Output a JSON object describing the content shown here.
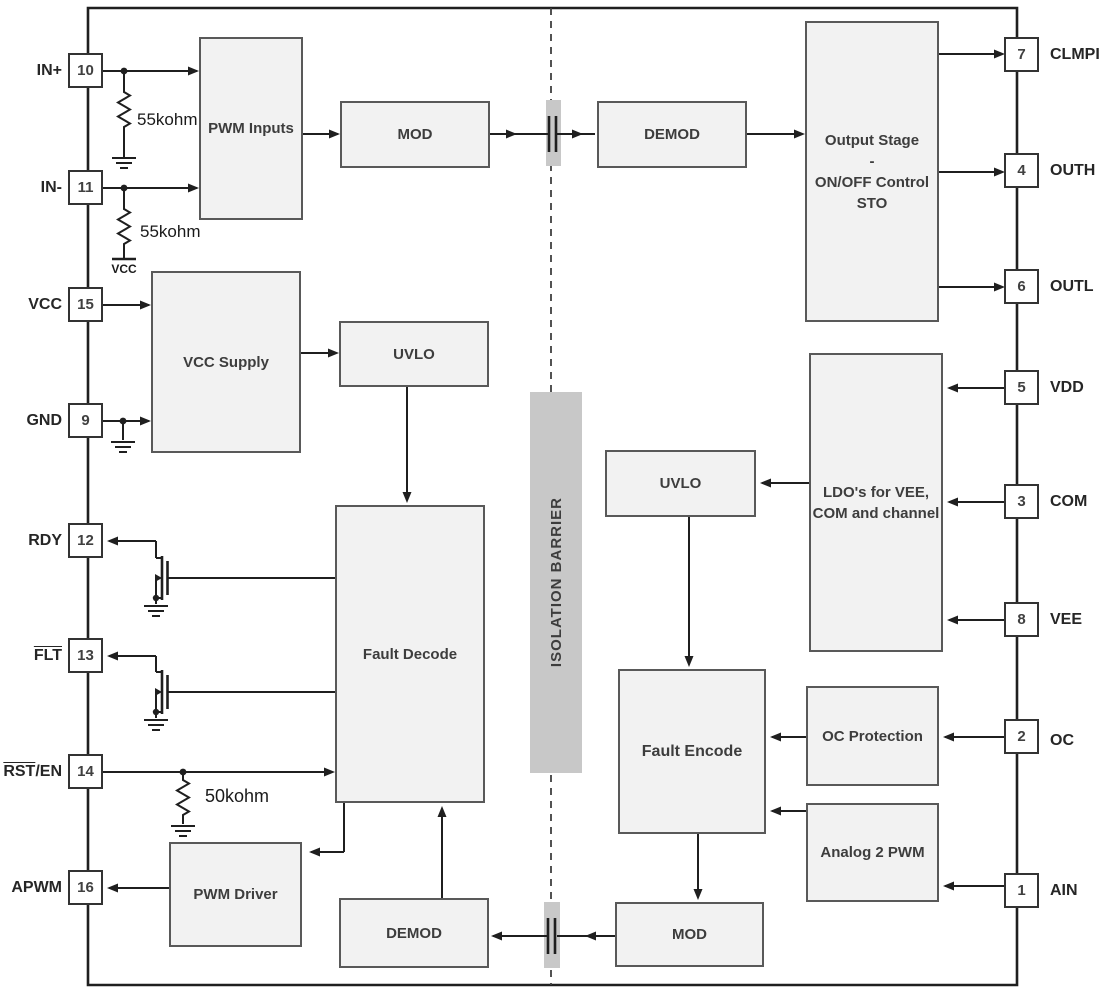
{
  "barrier": {
    "label": "ISOLATION BARRIER"
  },
  "left_pins": [
    {
      "num": "10",
      "over": "",
      "rest": "IN+"
    },
    {
      "num": "11",
      "over": "",
      "rest": "IN-"
    },
    {
      "num": "15",
      "over": "",
      "rest": "VCC"
    },
    {
      "num": "9",
      "over": "",
      "rest": "GND"
    },
    {
      "num": "12",
      "over": "",
      "rest": "RDY"
    },
    {
      "num": "13",
      "over": "FLT",
      "rest": ""
    },
    {
      "num": "14",
      "over": "RST",
      "rest": "/EN"
    },
    {
      "num": "16",
      "over": "",
      "rest": "APWM"
    }
  ],
  "right_pins": [
    {
      "num": "7",
      "label": "CLMPI"
    },
    {
      "num": "4",
      "label": "OUTH"
    },
    {
      "num": "6",
      "label": "OUTL"
    },
    {
      "num": "5",
      "label": "VDD"
    },
    {
      "num": "3",
      "label": "COM"
    },
    {
      "num": "8",
      "label": "VEE"
    },
    {
      "num": "2",
      "label": "OC"
    },
    {
      "num": "1",
      "label": "AIN"
    }
  ],
  "blocks": {
    "pwm_inputs": {
      "label": "PWM Inputs"
    },
    "mod_top": {
      "label": "MOD"
    },
    "demod_top": {
      "label": "DEMOD"
    },
    "output_stage": {
      "lines": [
        "Output Stage",
        "-",
        "ON/OFF Control",
        "STO"
      ]
    },
    "vcc_supply": {
      "label": "VCC Supply"
    },
    "uvlo_left": {
      "label": "UVLO"
    },
    "fault_decode": {
      "label": "Fault Decode"
    },
    "uvlo_right": {
      "label": "UVLO"
    },
    "ldo": {
      "lines": [
        "LDO's for VEE,",
        "COM and channel"
      ]
    },
    "fault_encode": {
      "label": "Fault Encode"
    },
    "oc_protection": {
      "label": "OC Protection"
    },
    "analog_2_pwm": {
      "label": "Analog 2 PWM"
    },
    "pwm_driver": {
      "label": "PWM Driver"
    },
    "demod_bottom": {
      "label": "DEMOD"
    },
    "mod_bottom": {
      "label": "MOD"
    }
  },
  "resistors": {
    "r_in_plus": "55kohm",
    "r_in_minus": "55kohm",
    "r_rst_en": "50kohm"
  },
  "rails": {
    "vcc": "VCC"
  },
  "colors": {
    "block_fill": "#f2f2f2",
    "block_border": "#595959",
    "wire": "#1f1f1f",
    "barrier_fill": "#c8c8c8",
    "dash": "#404040"
  }
}
